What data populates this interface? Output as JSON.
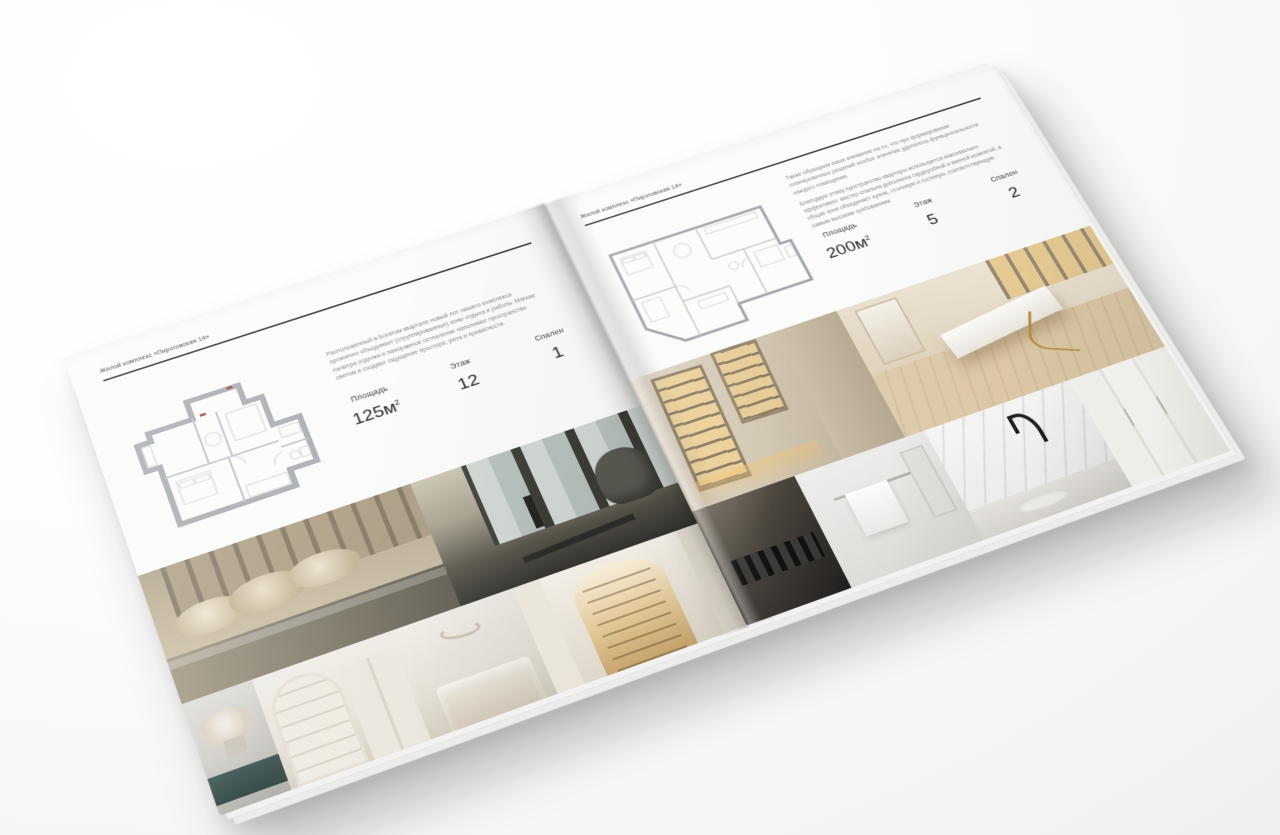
{
  "brand": {
    "accent": "#3f3f3f",
    "page_color": "#fbfbf9"
  },
  "left_page": {
    "caption": "Жилой комплекс «Пироговская 14»",
    "paragraphs": [
      "Расположенный в Богатом квартале новый лот нашего комплекса органично объединяет (сгруппированные) зоны отдыха и работы. Мягкая палитра отделки и панорамное остекление наполняют пространство светом и создают ощущение простора, уюта и приватности."
    ],
    "stats": {
      "area": {
        "label": "Площадь",
        "value": "125м",
        "sup": "2"
      },
      "floor": {
        "label": "Этаж",
        "value": "12"
      },
      "bedrooms": {
        "label": "Спален",
        "value": "1"
      }
    }
  },
  "right_page": {
    "caption": "Жилой комплекс «Пироговская 14»",
    "paragraphs": [
      "Также обращаем ваше внимание на то, что при формировании планировочных решений особое значение уделялось функциональности каждого помещения.",
      "Благодаря этому пространство квартиры используется максимально эффективно: мастер-спальня дополнена гардеробной и ванной комнатой, а общая зона объединяет кухню, столовую и гостиную, соответствующую самым высоким требованиям."
    ],
    "stats": {
      "area": {
        "label": "Площадь",
        "value": "200м",
        "sup": "2"
      },
      "floor": {
        "label": "Этаж",
        "value": "5"
      },
      "bedrooms": {
        "label": "Спален",
        "value": "2"
      }
    }
  }
}
